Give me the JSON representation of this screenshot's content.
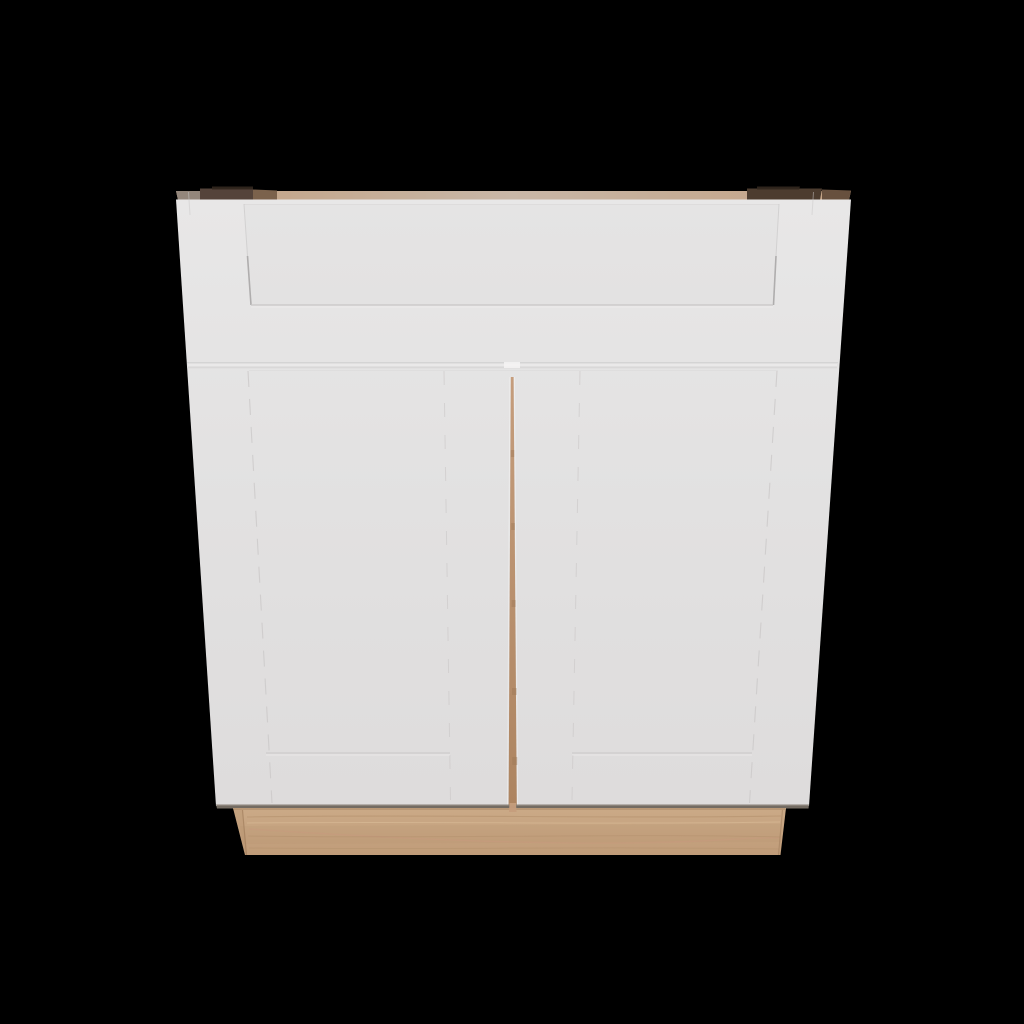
{
  "scene": {
    "type": "3d-product-render",
    "subject": "Shaker-style base cabinet with two doors and one top drawer, white painted fronts, unfinished natural wood toe kick, viewed from slightly above on a black background",
    "background_color": "#000000"
  },
  "cabinet": {
    "style": "shaker",
    "door_count": 2,
    "drawer_count": 1,
    "front_finish_color": "#e2e1e1",
    "toe_kick_wood_color": "#c5a17e",
    "top_edge_wood_color": "#c8b7a7"
  },
  "colors": {
    "background": "#000000",
    "face_top": "#e8e7e7",
    "face_mid": "#e2e1e1",
    "face_bottom": "#dedcdc",
    "strip_tan_left": "#c2a182",
    "strip_tan_center": "#c8b7a7",
    "strip_tan_right": "#c4a284",
    "strip_far_left": "#93867b",
    "strip_dark_left": "#54433a",
    "strip_mid_left": "#7b624c",
    "strip_dark_right": "#4c3c2f",
    "strip_mid_right": "#67503e",
    "strip_darkest": "#33281f",
    "panel_shadow": "#c9c7c7",
    "panel_shadow_dark": "#a9a6a6",
    "panel_shadow_faint": "#dbdada",
    "gap_band": "#e0dfdf",
    "gap_band_bright": "#f2f1f1",
    "gap_band_edge": "#d3d2d2",
    "highlight": "#f4f3f3",
    "center_gap_top": "#c59d7c",
    "center_gap_bottom": "#ad8460",
    "center_gap_dark": "#9d7757",
    "kick_top": "#cbaa87",
    "kick_bottom": "#c09c79",
    "kick_grain_dark": "#b08c68",
    "kick_grain_light": "#dcbf9b",
    "kick_grain_pink": "#c89a7d",
    "kick_edge": "#9c7a59",
    "under_door_shadow": "#7f776d"
  }
}
